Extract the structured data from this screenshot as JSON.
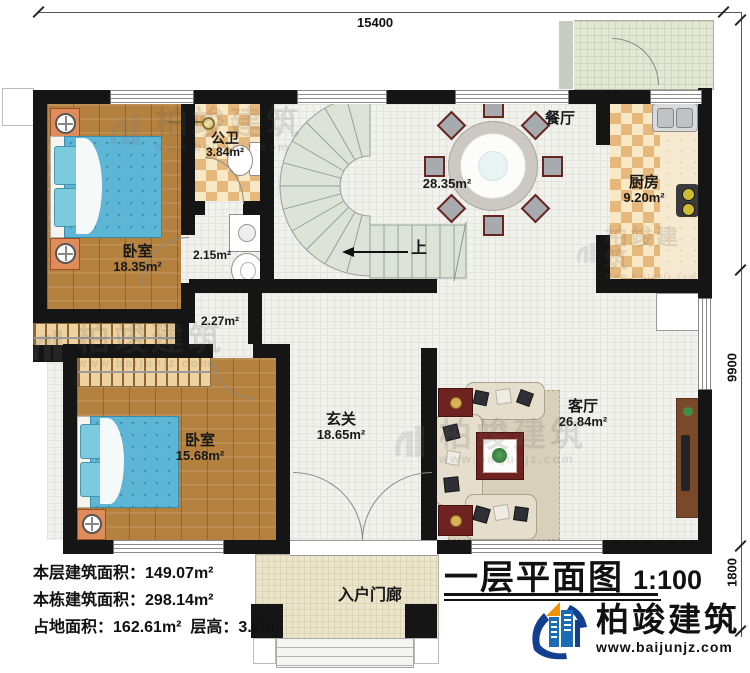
{
  "title_block": {
    "title": "一层平面图",
    "scale": "1:100"
  },
  "dimensions": {
    "top": "15400",
    "right_main": "9900",
    "right_porch": "1800"
  },
  "rooms": {
    "bedroom1": {
      "name": "卧室",
      "area": "18.35m²"
    },
    "bedroom2": {
      "name": "卧室",
      "area": "15.68m²"
    },
    "bathroom": {
      "name": "公卫",
      "area": "3.84m²"
    },
    "utility": {
      "area": "2.15m²"
    },
    "closet": {
      "area": "2.27m²"
    },
    "dining": {
      "name": "餐厅",
      "area": "28.35m²"
    },
    "kitchen": {
      "name": "厨房",
      "area": "9.20m²"
    },
    "hall": {
      "name": "玄关",
      "area": "18.65m²"
    },
    "living": {
      "name": "客厅",
      "area": "26.84m²"
    },
    "porch": {
      "name": "入户门廊"
    },
    "stairs": {
      "direction_label": "上"
    }
  },
  "stats": {
    "floor_area_label": "本层建筑面积：",
    "floor_area_value": "149.07m²",
    "building_area_label": "本栋建筑面积：",
    "building_area_value": "298.14m²",
    "land_area_label": "占地面积：",
    "land_area_value": "162.61m²",
    "floor_height_label": "层高：",
    "floor_height_value": "3.6m"
  },
  "branding": {
    "company": "柏竣建筑",
    "website": "www.baijunjz.com"
  },
  "watermark": {
    "company": "柏竣建筑",
    "website": "www.baijunjz.com"
  },
  "colors": {
    "wall": "#151515",
    "wood_floor": "#b5813f",
    "tile_floor": "#f1f1ee",
    "checker_dark": "#e7b87c",
    "checker_light": "#f8e8c6",
    "bed": "#5db6d6",
    "stairs": "#dde3d9",
    "porch_floor": "#ece5cb",
    "patio": "#e3e8d5",
    "logo_blue": "#1a6cb5",
    "logo_navy": "#123f8f",
    "logo_orange": "#f29200"
  }
}
